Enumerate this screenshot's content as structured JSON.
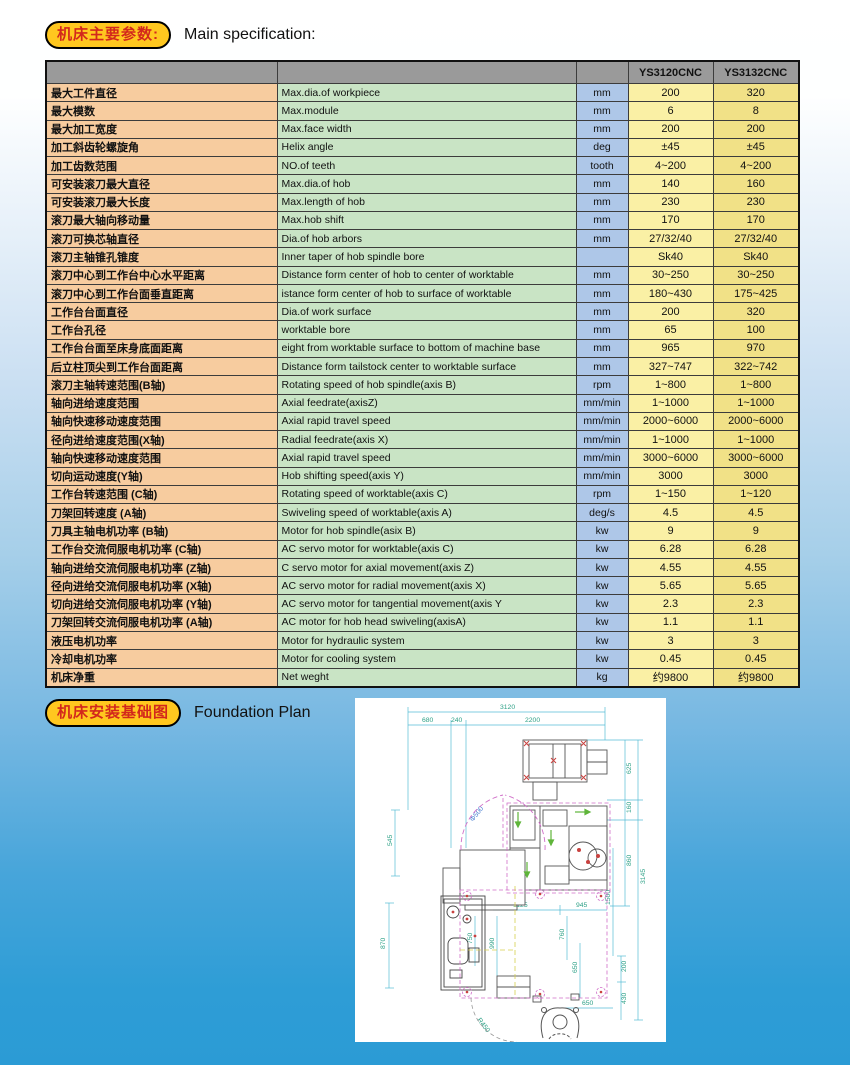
{
  "page": {
    "section1_badge": "机床主要参数:",
    "section1_title": "Main specification:",
    "section2_badge": "机床安装基础图",
    "section2_title": "Foundation Plan"
  },
  "colors": {
    "badge_fill": "#ffc71f",
    "badge_text": "#d3281c",
    "header_gray": "#9a9a9a",
    "col_chinese": "#f7cc9f",
    "col_english": "#c9e4c5",
    "col_unit": "#aec7e8",
    "col_model1": "#faf0a5",
    "col_model2": "#f1e187",
    "page_bottom_blue": "#2b9bd5"
  },
  "table": {
    "headers": {
      "model1": "YS3120CNC",
      "model2": "YS3132CNC"
    },
    "rows": [
      {
        "cn": "最大工件直径",
        "en": "Max.dia.of workpiece",
        "unit": "mm",
        "v1": "200",
        "v2": "320"
      },
      {
        "cn": "最大模数",
        "en": "Max.module",
        "unit": "mm",
        "v1": "6",
        "v2": "8"
      },
      {
        "cn": "最大加工宽度",
        "en": "Max.face width",
        "unit": "mm",
        "v1": "200",
        "v2": "200"
      },
      {
        "cn": "加工斜齿轮螺旋角",
        "en": "Helix angle",
        "unit": "deg",
        "v1": "±45",
        "v2": "±45"
      },
      {
        "cn": "加工齿数范围",
        "en": "NO.of teeth",
        "unit": "tooth",
        "v1": "4~200",
        "v2": "4~200"
      },
      {
        "cn": "可安装滚刀最大直径",
        "en": "Max.dia.of  hob",
        "unit": "mm",
        "v1": "140",
        "v2": "160"
      },
      {
        "cn": "可安装滚刀最大长度",
        "en": "Max.length of hob",
        "unit": "mm",
        "v1": "230",
        "v2": "230"
      },
      {
        "cn": "滚刀最大轴向移动量",
        "en": "Max.hob shift",
        "unit": "mm",
        "v1": "170",
        "v2": "170"
      },
      {
        "cn": "滚刀可换芯轴直径",
        "en": "Dia.of hob arbors",
        "unit": "mm",
        "v1": "27/32/40",
        "v2": "27/32/40"
      },
      {
        "cn": "滚刀主轴锥孔锥度",
        "en": "Inner taper of hob spindle bore",
        "unit": "",
        "v1": "Sk40",
        "v2": "Sk40"
      },
      {
        "cn": "滚刀中心到工作台中心水平距离",
        "en": "Distance form center of hob to center of worktable",
        "unit": "mm",
        "v1": "30~250",
        "v2": "30~250"
      },
      {
        "cn": "滚刀中心到工作台面垂直距离",
        "en": "istance form center of hob to surface of worktable",
        "unit": "mm",
        "v1": "180~430",
        "v2": "175~425"
      },
      {
        "cn": "工作台台面直径",
        "en": "Dia.of work surface",
        "unit": "mm",
        "v1": "200",
        "v2": "320"
      },
      {
        "cn": "工作台孔径",
        "en": "worktable bore",
        "unit": "mm",
        "v1": "65",
        "v2": "100"
      },
      {
        "cn": "工作台台面至床身底面距离",
        "en": "eight from worktable surface to bottom of machine base",
        "unit": "mm",
        "v1": "965",
        "v2": "970"
      },
      {
        "cn": "后立柱顶尖到工作台面距离",
        "en": "Distance form tailstock center to worktable surface",
        "unit": "mm",
        "v1": "327~747",
        "v2": "322~742"
      },
      {
        "cn": "滚刀主轴转速范围(B轴)",
        "en": "Rotating speed of hob spindle(axis B)",
        "unit": "rpm",
        "v1": "1~800",
        "v2": "1~800"
      },
      {
        "cn": "轴向进给速度范围",
        "en": "Axial  feedrate(axisZ)",
        "unit": "mm/min",
        "v1": "1~1000",
        "v2": "1~1000"
      },
      {
        "cn": "轴向快速移动速度范围",
        "en": "Axial  rapid travel speed",
        "unit": "mm/min",
        "v1": "2000~6000",
        "v2": "2000~6000"
      },
      {
        "cn": "径向进给速度范围(X轴)",
        "en": "Radial feedrate(axis X)",
        "unit": "mm/min",
        "v1": "1~1000",
        "v2": "1~1000"
      },
      {
        "cn": "轴向快速移动速度范围",
        "en": "Axial  rapid travel speed",
        "unit": "mm/min",
        "v1": "3000~6000",
        "v2": "3000~6000"
      },
      {
        "cn": "切向运动速度(Y轴)",
        "en": "Hob shifting speed(axis Y)",
        "unit": "mm/min",
        "v1": "3000",
        "v2": "3000"
      },
      {
        "cn": "工作台转速范围 (C轴)",
        "en": "Rotating speed of worktable(axis C)",
        "unit": "rpm",
        "v1": "1~150",
        "v2": "1~120"
      },
      {
        "cn": "刀架回转速度 (A轴)",
        "en": "Swiveling speed of worktable(axis A)",
        "unit": "deg/s",
        "v1": "4.5",
        "v2": "4.5"
      },
      {
        "cn": "刀具主轴电机功率 (B轴)",
        "en": "Motor for hob spindle(asix B)",
        "unit": "kw",
        "v1": "9",
        "v2": "9"
      },
      {
        "cn": "工作台交流伺服电机功率 (C轴)",
        "en": "AC servo motor for worktable(axis C)",
        "unit": "kw",
        "v1": "6.28",
        "v2": "6.28"
      },
      {
        "cn": "轴向进给交流伺服电机功率 (Z轴)",
        "en": "C servo motor for axial movement(axis Z)",
        "unit": "kw",
        "v1": "4.55",
        "v2": "4.55"
      },
      {
        "cn": "径向进给交流伺服电机功率 (X轴)",
        "en": "AC servo motor for radial movement(axis X)",
        "unit": "kw",
        "v1": "5.65",
        "v2": "5.65"
      },
      {
        "cn": "切向进给交流伺服电机功率 (Y轴)",
        "en": "AC servo motor for tangential movement(axis Y",
        "unit": "kw",
        "v1": "2.3",
        "v2": "2.3"
      },
      {
        "cn": "刀架回转交流伺服电机功率 (A轴)",
        "en": "AC motor for hob head swiveling(axisA)",
        "unit": "kw",
        "v1": "1.1",
        "v2": "1.1"
      },
      {
        "cn": "液压电机功率",
        "en": "Motor for hydraulic system",
        "unit": "kw",
        "v1": "3",
        "v2": "3"
      },
      {
        "cn": "冷却电机功率",
        "en": "Motor for cooling   system",
        "unit": "kw",
        "v1": "0.45",
        "v2": "0.45"
      },
      {
        "cn": "机床净重",
        "en": "Net weght",
        "unit": "kg",
        "v1": "约9800",
        "v2": "约9800"
      }
    ]
  },
  "foundation": {
    "dims": {
      "total_width": "3120",
      "seg_a": "680",
      "seg_b": "240",
      "seg_c": "2200",
      "right_a": "625",
      "right_b": "160",
      "right_c": "860",
      "right_total": "3145",
      "left_a": "545",
      "left_b": "870",
      "door_dia": "Φ500",
      "inner_w1": "1125",
      "inner_w2": "945",
      "inner_v1": "750",
      "inner_v2": "990",
      "inner_v3": "760",
      "inner_v4": "650",
      "right_d": "1500",
      "right_e": "200",
      "right_f": "430",
      "front_w": "650",
      "door_r": "R450",
      "center_mark": "??"
    }
  }
}
